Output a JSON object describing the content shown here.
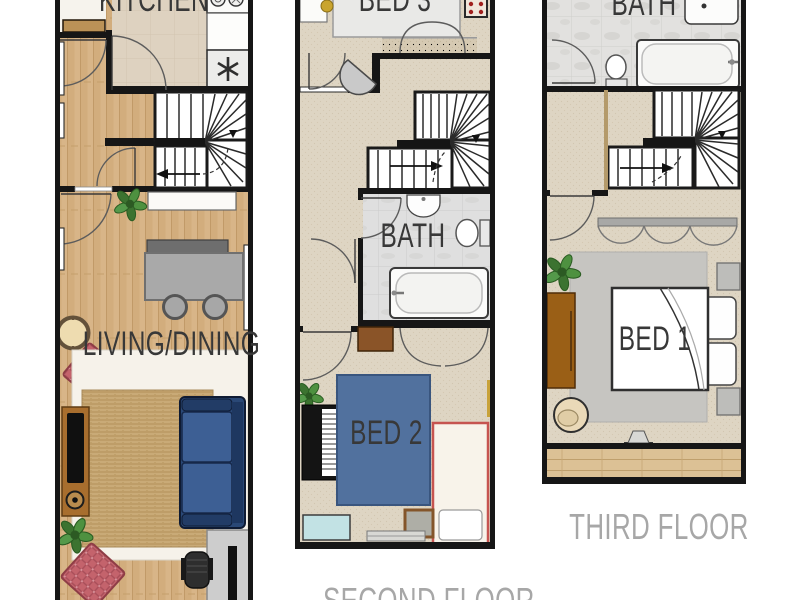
{
  "plans": {
    "first": {
      "kitchen_label": "KITCHEN",
      "living_dining_label": "LIVING/DINING"
    },
    "second": {
      "bed3_label": "BED 3",
      "bath_label": "BATH",
      "bed2_label": "BED 2",
      "caption": "SECOND FLOOR"
    },
    "third": {
      "bath_label": "BATH",
      "bed1_label": "BED 1",
      "caption": "THIRD FLOOR"
    }
  },
  "colors": {
    "wall": "#1a1a1a",
    "wood_floor": "#d5b184",
    "carpet": "#ded5c3",
    "bath_tile": "#e0e0de",
    "jute_rug": "#c9aa77",
    "bed2_blue": "#51719e",
    "sofa_navy": "#2a4876",
    "plaid_red": "#c4636c",
    "pouf_yellow": "#c7a12c",
    "timber_brown": "#9a5f16",
    "room_label": "#383838",
    "caption_gray": "#a7a7a7"
  }
}
